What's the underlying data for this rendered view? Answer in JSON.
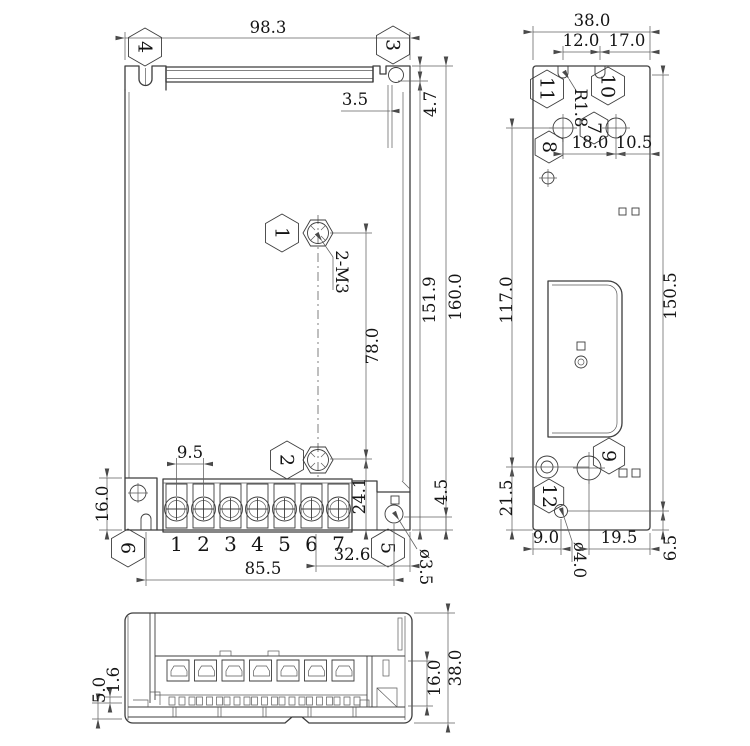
{
  "front": {
    "dim_width_top": "98.3",
    "dim_hole_offset": "3.5",
    "dim_flange_depth": "4.7",
    "dim_body_height": "151.9",
    "dim_total_height": "160.0",
    "dim_screw_span": "78.0",
    "label_thread": "2-M3",
    "dim_terminal_pitch": "9.5",
    "dim_bottom_span": "24.1",
    "dim_hole_bottom": "4.5",
    "dim_flange_height": "16.0",
    "dim_hole_span": "32.6",
    "dim_mount_span": "85.5",
    "label_hole_dia": "ø3.5",
    "terminals": [
      "1",
      "2",
      "3",
      "4",
      "5",
      "6",
      "7"
    ],
    "balloons": {
      "b1": "1",
      "b2": "2",
      "b3": "3",
      "b4": "4",
      "b5": "5",
      "b6": "6"
    }
  },
  "side": {
    "dim_width": "38.0",
    "dim_notch_spacing": "12.0",
    "dim_notch_edge": "17.0",
    "label_radius": "R1.8",
    "dim_hole_spacing": "18.0",
    "dim_hole_edge": "10.5",
    "dim_mid_height": "117.0",
    "dim_right_height": "150.5",
    "dim_lower_height": "21.5",
    "dim_foot": "9.0",
    "label_hole_dia": "ø4.0",
    "dim_bottom_span": "19.5",
    "dim_corner": "6.5",
    "balloons": {
      "b7": "7",
      "b8": "8",
      "b9": "9",
      "b10": "10",
      "b11": "11",
      "b12": "12"
    }
  },
  "bottom": {
    "dim_lip": "1.6",
    "dim_base": "5.0",
    "dim_terminal_height": "16.0",
    "dim_depth": "38.0"
  }
}
